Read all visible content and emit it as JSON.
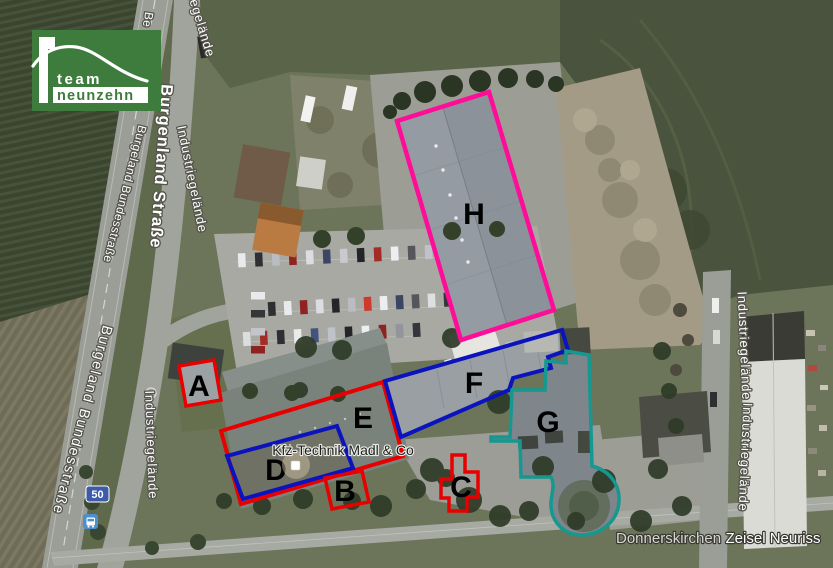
{
  "logo": {
    "team": "team",
    "neunzehn": "neunzehn",
    "color": "#3e7c3e"
  },
  "streets": {
    "burgenland_strasse": "Burgenland Straße",
    "burgeland_bundesstrasse": "Burgeland Bundesstraße",
    "industriegelaende": "Industriegelände",
    "be_fragment": "Be"
  },
  "places": {
    "district": "Donnerskirchen",
    "area": "Zeisel Neuriss"
  },
  "business": {
    "name": "Kfz-Technik Madl & Co"
  },
  "transit": {
    "route_number": "50",
    "badge_color": "#3d5ba9",
    "bus_color": "#4d8fd1"
  },
  "buildings": {
    "a": {
      "label": "A",
      "color": "#e80000"
    },
    "b": {
      "label": "B",
      "color": "#e80000"
    },
    "c": {
      "label": "C",
      "color": "#e80000"
    },
    "d": {
      "label": "D",
      "color": "#0a13be"
    },
    "e": {
      "label": "E",
      "color": "#e80000"
    },
    "f": {
      "label": "F",
      "color": "#0a13be"
    },
    "g": {
      "label": "G",
      "color": "#14988f"
    },
    "h": {
      "label": "H",
      "color": "#ff0d98"
    }
  }
}
